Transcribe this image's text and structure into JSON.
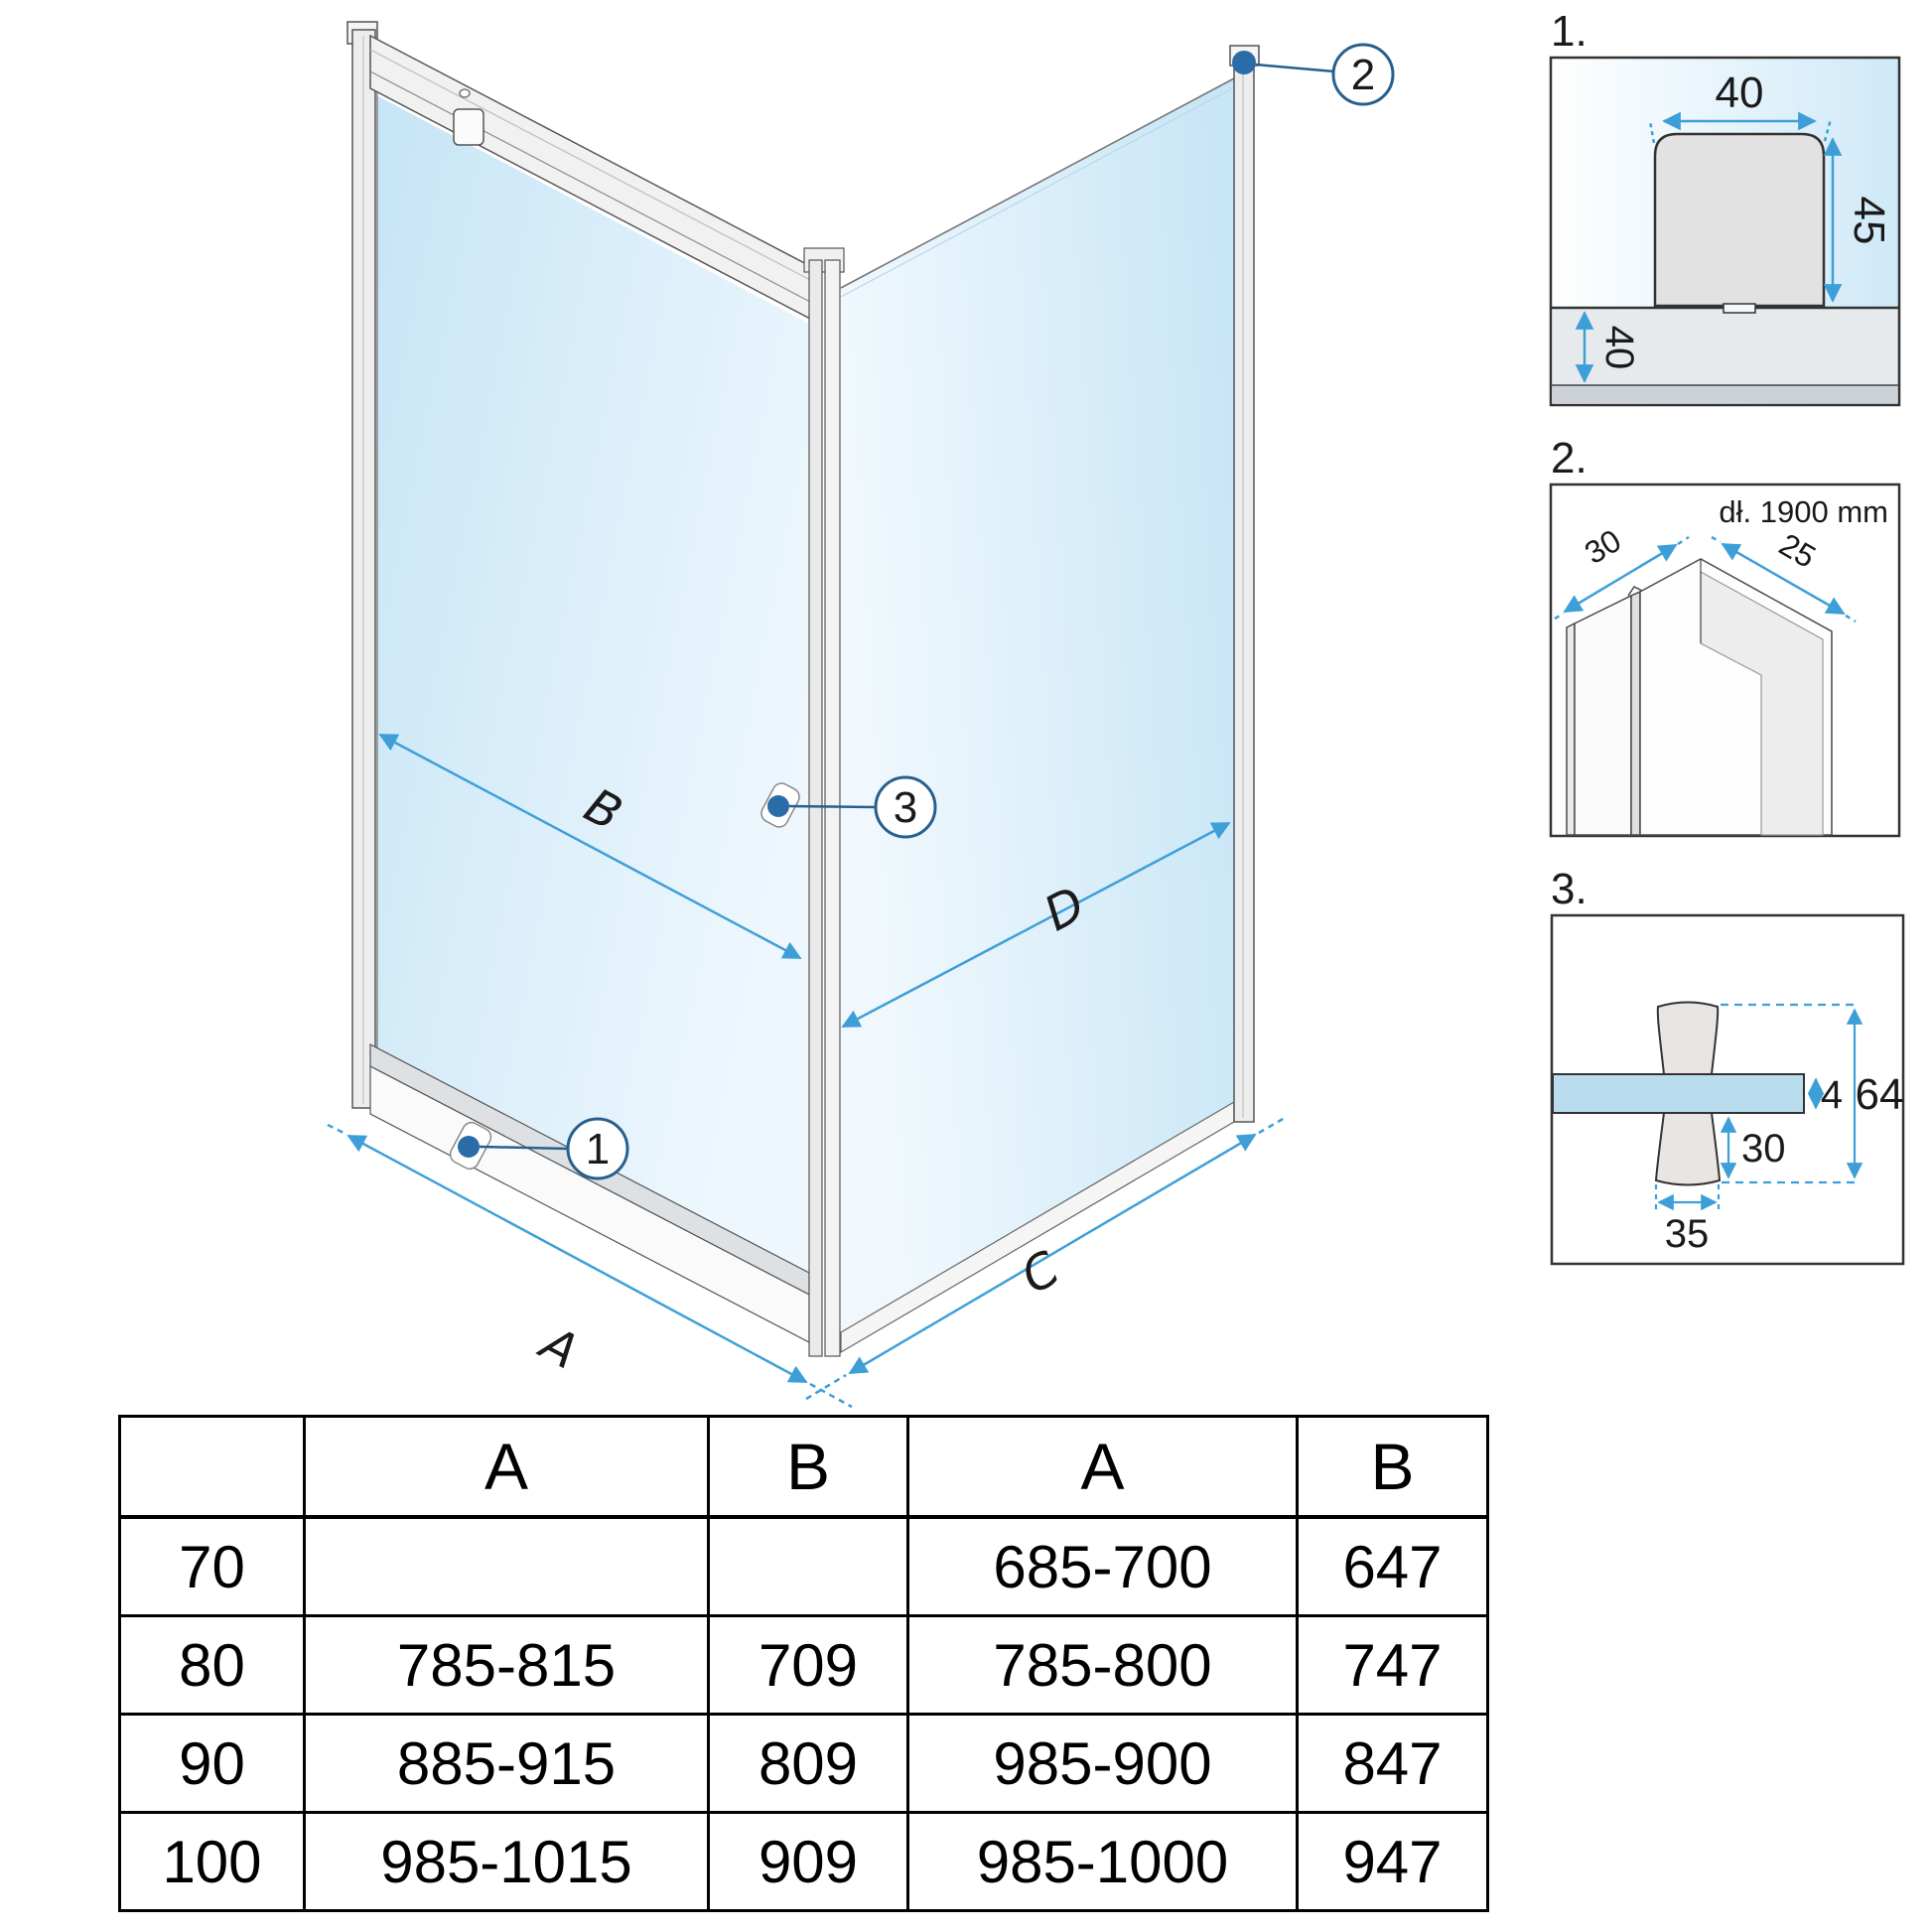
{
  "diagram": {
    "dim_labels": {
      "a": "A",
      "b": "B",
      "c": "C",
      "d": "D"
    },
    "callouts": {
      "c1": "1",
      "c2": "2",
      "c3": "3"
    },
    "colors": {
      "dimension_blue": "#3E9FD8",
      "callout_blue": "#27608E",
      "dot_blue": "#2A6CA8",
      "glass_blue": "#C8E6F7",
      "detail_glass_blue": "#B9DCEE"
    }
  },
  "details": {
    "d1": {
      "index": "1.",
      "width": "40",
      "height": "45",
      "tray": "40"
    },
    "d2": {
      "index": "2.",
      "length": "dł. 1900 mm",
      "left": "30",
      "right": "25"
    },
    "d3": {
      "index": "3.",
      "glass": "4",
      "total": "64",
      "knob_height": "30",
      "knob_width": "35"
    }
  },
  "table": {
    "headers": [
      "",
      "A",
      "B",
      "A",
      "B"
    ],
    "rows": [
      [
        "70",
        "",
        "",
        "685-700",
        "647"
      ],
      [
        "80",
        "785-815",
        "709",
        "785-800",
        "747"
      ],
      [
        "90",
        "885-915",
        "809",
        "985-900",
        "847"
      ],
      [
        "100",
        "985-1015",
        "909",
        "985-1000",
        "947"
      ]
    ]
  }
}
